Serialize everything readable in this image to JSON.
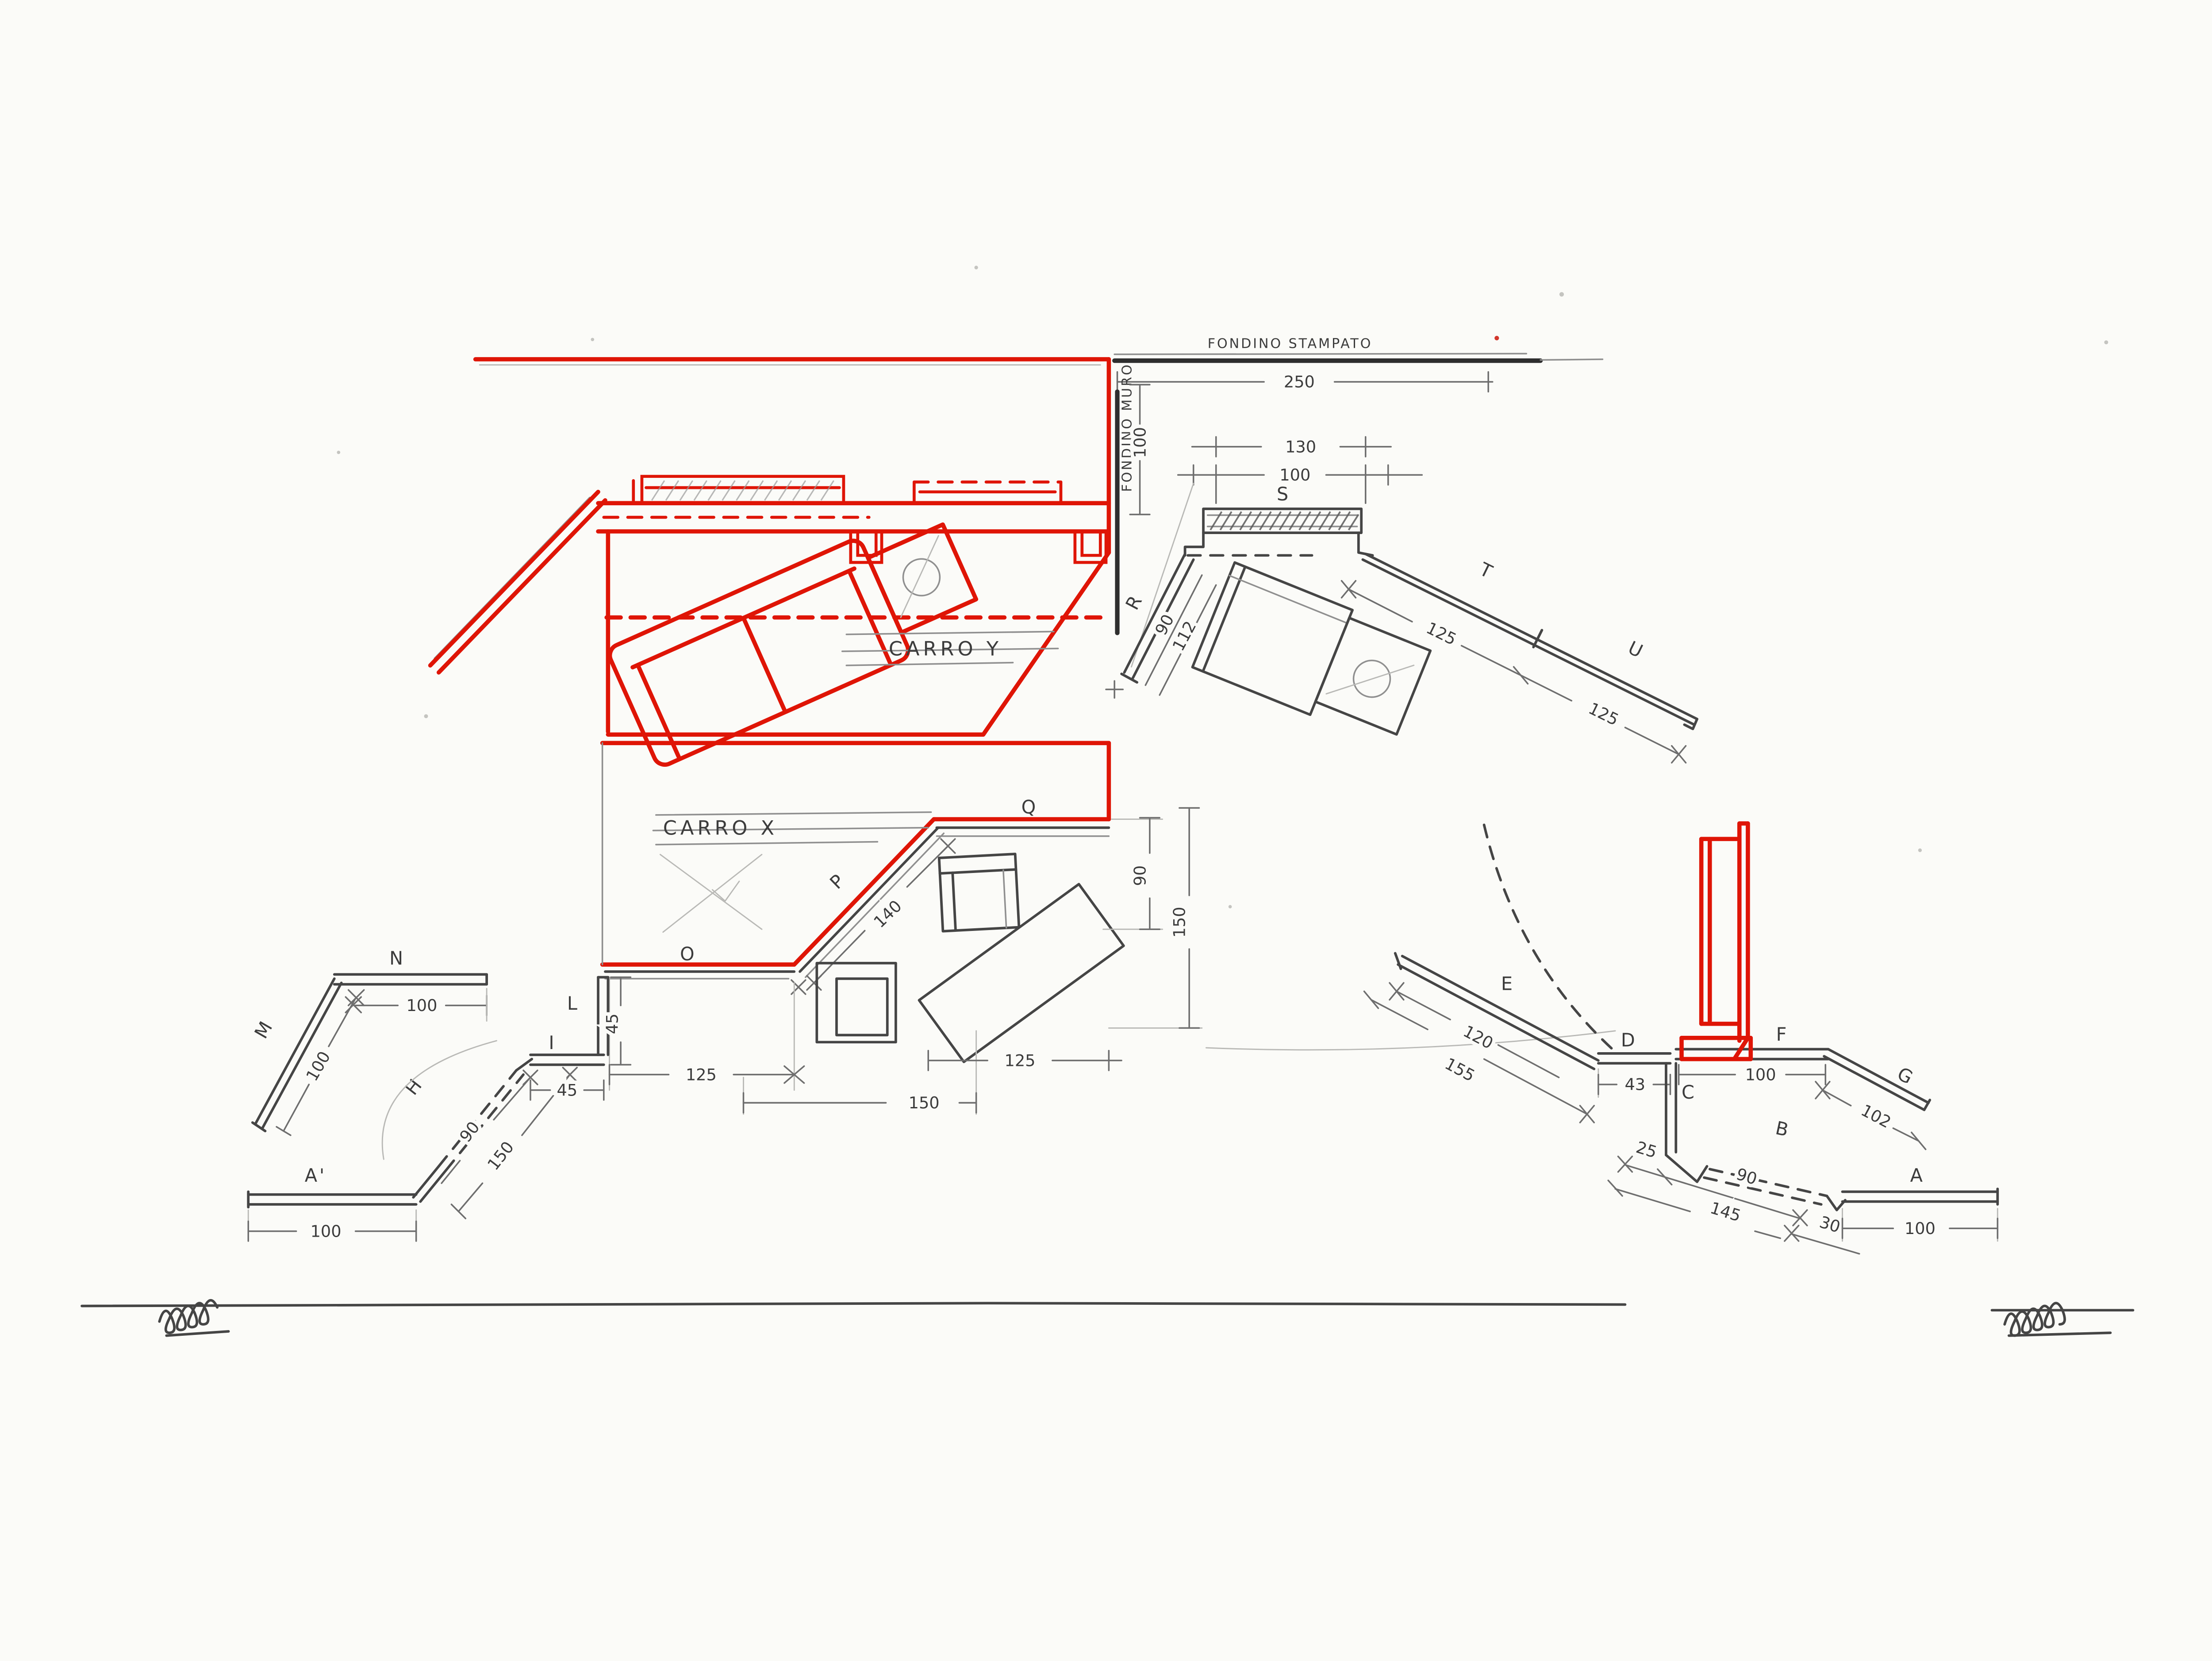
{
  "labels": {
    "fondino_stampato": "FONDINO STAMPATO",
    "fondino_muro": "FONDINO MURO",
    "carro_y": "CARRO Y",
    "carro_x": "CARRO X"
  },
  "walls": {
    "s": "S",
    "r": "R",
    "t": "T",
    "u": "U",
    "m": "M",
    "n": "N",
    "l": "L",
    "i": "I",
    "h": "H",
    "a_prime": "A'",
    "o": "O",
    "p": "P",
    "q": "Q",
    "a": "A",
    "b": "B",
    "c": "C",
    "d": "D",
    "e": "E",
    "f": "F",
    "g": "G"
  },
  "dims": {
    "top_250": "250",
    "muro_100": "100",
    "s_130": "130",
    "s_100": "100",
    "r_90": "90",
    "r_112": "112",
    "t_125": "125",
    "u_125": "125",
    "p_140": "140",
    "x_right_90": "90",
    "x_right_150": "150",
    "x_bottom_left_125": "125",
    "x_bottom_150": "150",
    "x_bottom_right_125": "125",
    "n_100": "100",
    "m_100": "100",
    "h_90": "90",
    "h_150": "150",
    "step_45_h": "45",
    "step_45_v": "45",
    "a_prime_100": "100",
    "e_120": "120",
    "e_155": "155",
    "d_43": "43",
    "f_100": "100",
    "g_102": "102",
    "b_25": "25",
    "b_90": "90",
    "b_145": "145",
    "b_30": "30",
    "a_100": "100"
  },
  "colors": {
    "red": "#df1506",
    "pencil": "#454545",
    "pencil_dark": "#2e2e2e",
    "pencil_light": "#8f8f8f",
    "paper": "#fbfbf8"
  }
}
